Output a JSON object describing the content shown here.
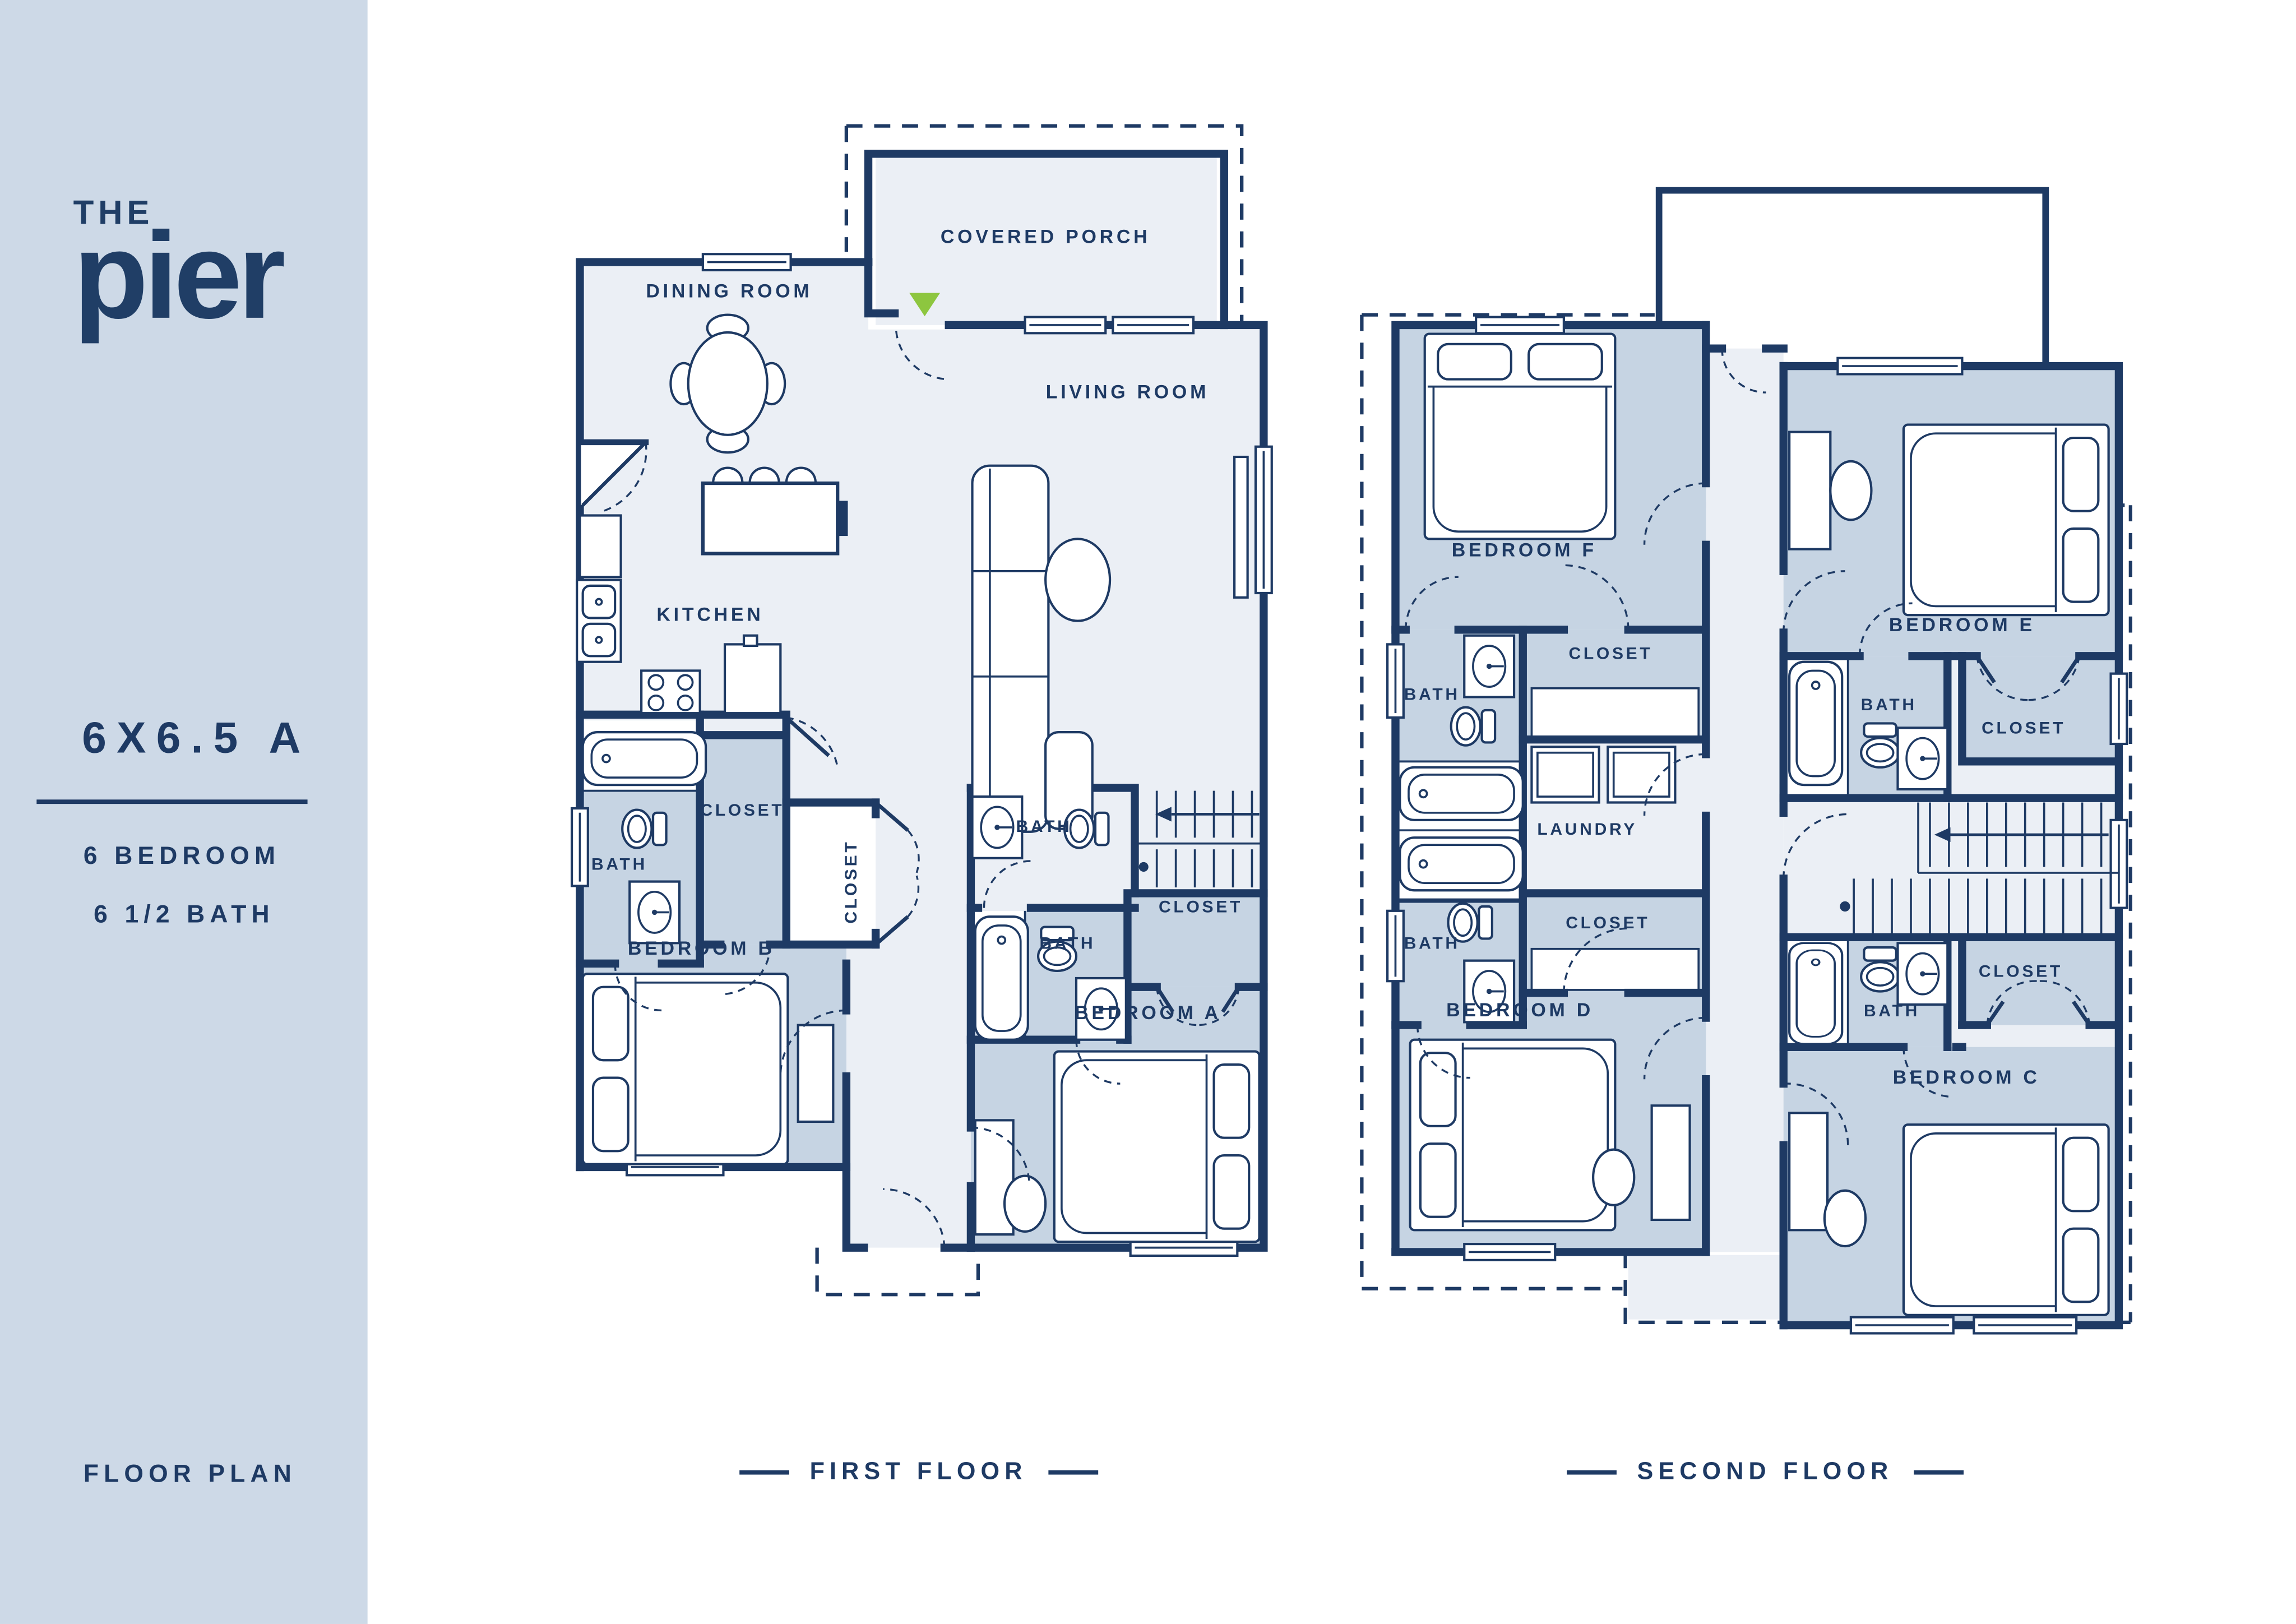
{
  "colors": {
    "navy": "#1e3a64",
    "room_blue": "#c6d4e3",
    "floor_light": "#ebeff5",
    "sidebar_bg": "#cdd9e7",
    "accent_green": "#8dc63f",
    "white": "#ffffff"
  },
  "sidebar": {
    "brand_top": "THE",
    "brand": "pier",
    "plan_name": "6X6.5 A",
    "spec_bedrooms": "6 BEDROOM",
    "spec_baths": "6 1/2 BATH",
    "footer": "FLOOR PLAN"
  },
  "first_floor": {
    "title": "FIRST FLOOR",
    "labels": {
      "covered_porch": "COVERED PORCH",
      "dining_room": "DINING ROOM",
      "living_room": "LIVING ROOM",
      "kitchen": "KITCHEN",
      "bath_b": "BATH",
      "closet_b": "CLOSET",
      "hall_closet": "CLOSET",
      "hall_bath": "BATH",
      "bedroom_b": "BEDROOM B",
      "bath_a": "BATH",
      "closet_a": "CLOSET",
      "bedroom_a": "BEDROOM A"
    }
  },
  "second_floor": {
    "title": "SECOND FLOOR",
    "labels": {
      "bedroom_f": "BEDROOM F",
      "bath_f": "BATH",
      "closet_f": "CLOSET",
      "laundry": "LAUNDRY",
      "bath_d": "BATH",
      "closet_d": "CLOSET",
      "bedroom_d": "BEDROOM D",
      "bedroom_e": "BEDROOM E",
      "bath_e": "BATH",
      "closet_e": "CLOSET",
      "bath_c": "BATH",
      "closet_c": "CLOSET",
      "bedroom_c": "BEDROOM C"
    }
  }
}
